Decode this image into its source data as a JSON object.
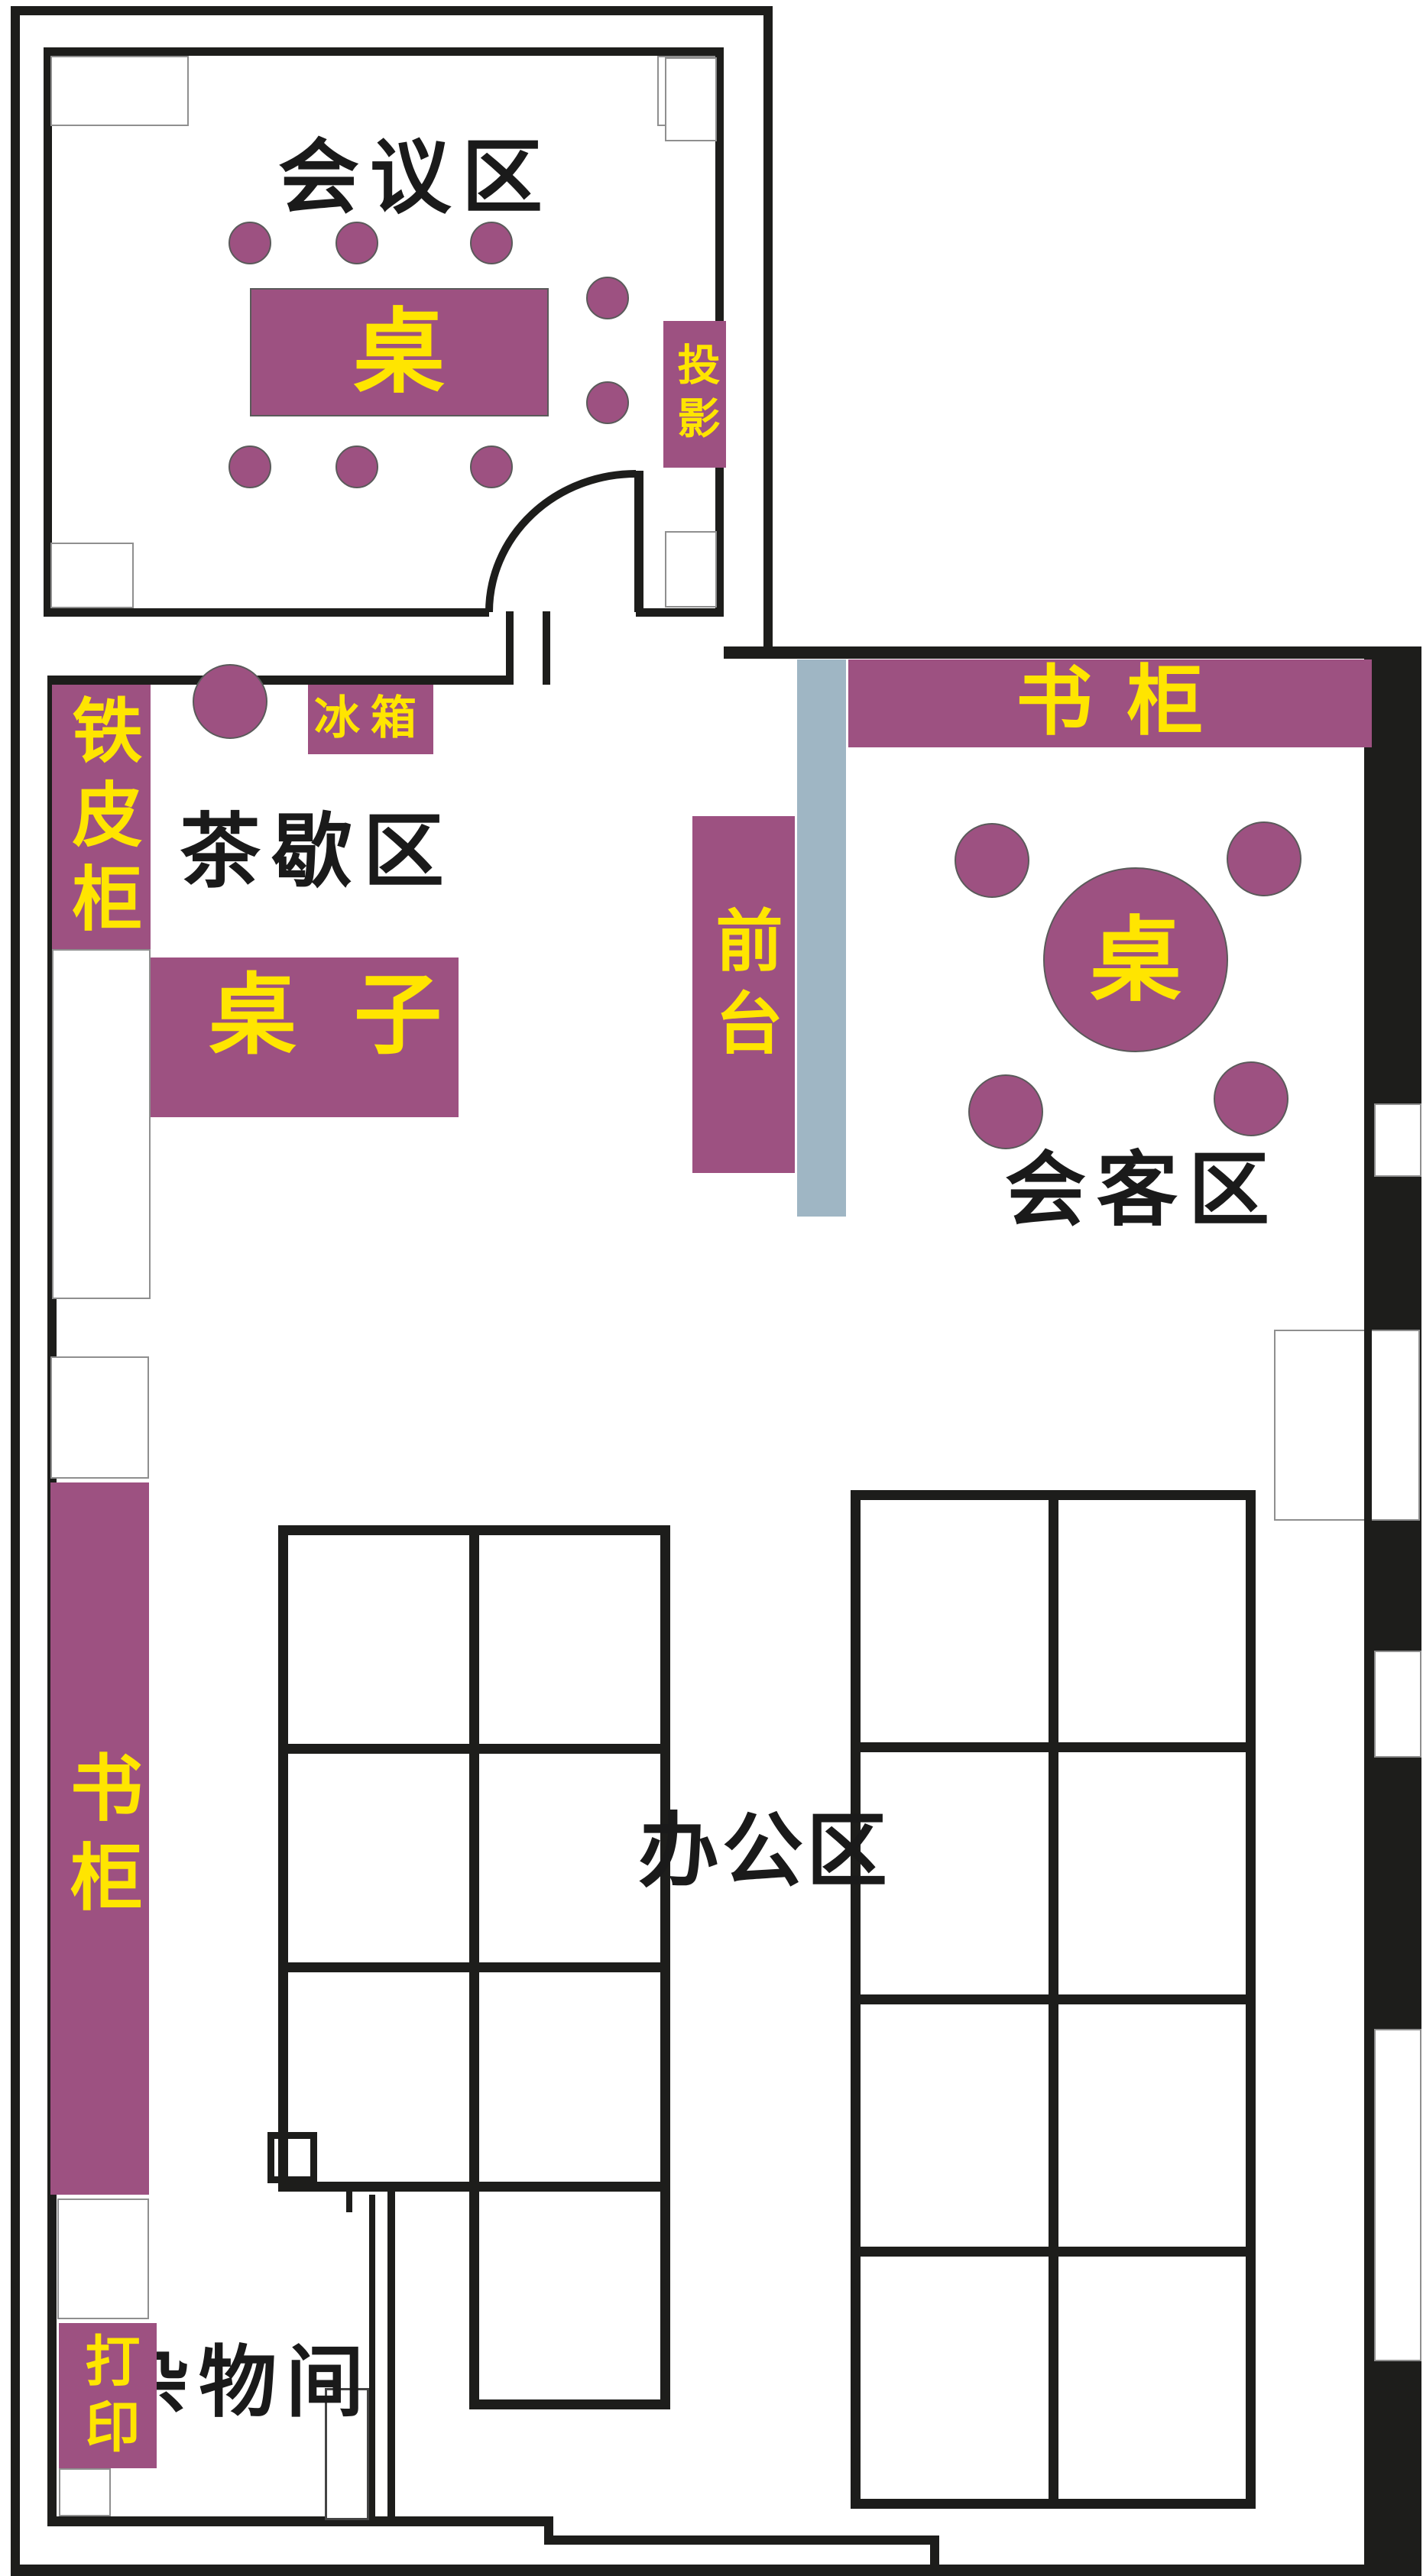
{
  "title": "办公室平面图",
  "colors": {
    "furniture_purple": "#9d5181",
    "text_yellow": "#ffe500",
    "wall_black": "#1d1d1b",
    "partition_gray": "#9fb6c4",
    "window_outline": "#8f8f8f",
    "label_black": "#1a1a1a"
  },
  "rooms": {
    "meeting": {
      "label": "会议区",
      "table_label": "桌",
      "projector_label": "投影"
    },
    "tea": {
      "label": "茶歇区",
      "cabinet_label": "铁皮柜",
      "fridge_label": "冰箱",
      "table_label": "桌子"
    },
    "reception": {
      "desk_label": "前台",
      "bookcase_label": "书柜"
    },
    "guest": {
      "label": "会客区",
      "table_label": "桌"
    },
    "office": {
      "label": "办公区",
      "bookcase_label": "书柜"
    },
    "storage": {
      "label": "杂物间",
      "printer_label": "打印"
    }
  }
}
